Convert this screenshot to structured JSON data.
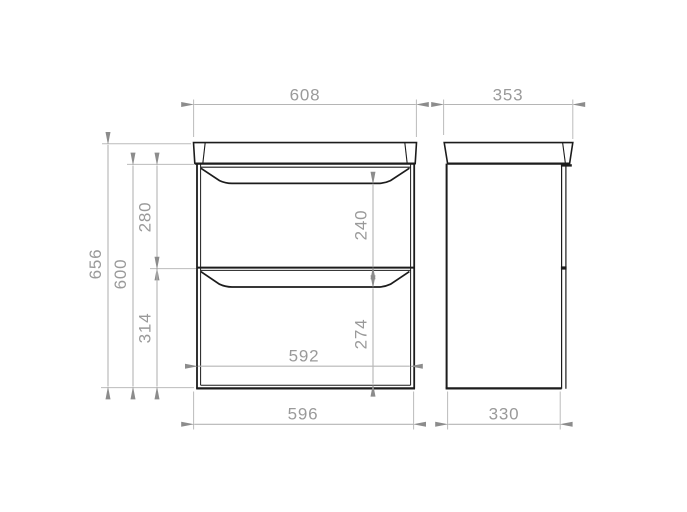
{
  "drawing": {
    "type": "technical-dimension-drawing",
    "subject": "two-drawer vanity unit with countertop",
    "units": "mm",
    "colors": {
      "background": "#ffffff",
      "outline": "#1c1c1c",
      "dimension_line": "#b5b5b5",
      "arrow": "#8c8c8c",
      "dimension_text": "#9a9a9a"
    },
    "front_view": {
      "countertop_width": "608",
      "total_height": "656",
      "body_height": "600",
      "top_drawer_section_height": "280",
      "top_drawer_inner_height": "240",
      "bottom_drawer_section_height": "314",
      "bottom_drawer_inner_height": "274",
      "inner_width": "592",
      "body_width": "596"
    },
    "side_view": {
      "countertop_depth": "353",
      "body_depth": "330"
    }
  }
}
